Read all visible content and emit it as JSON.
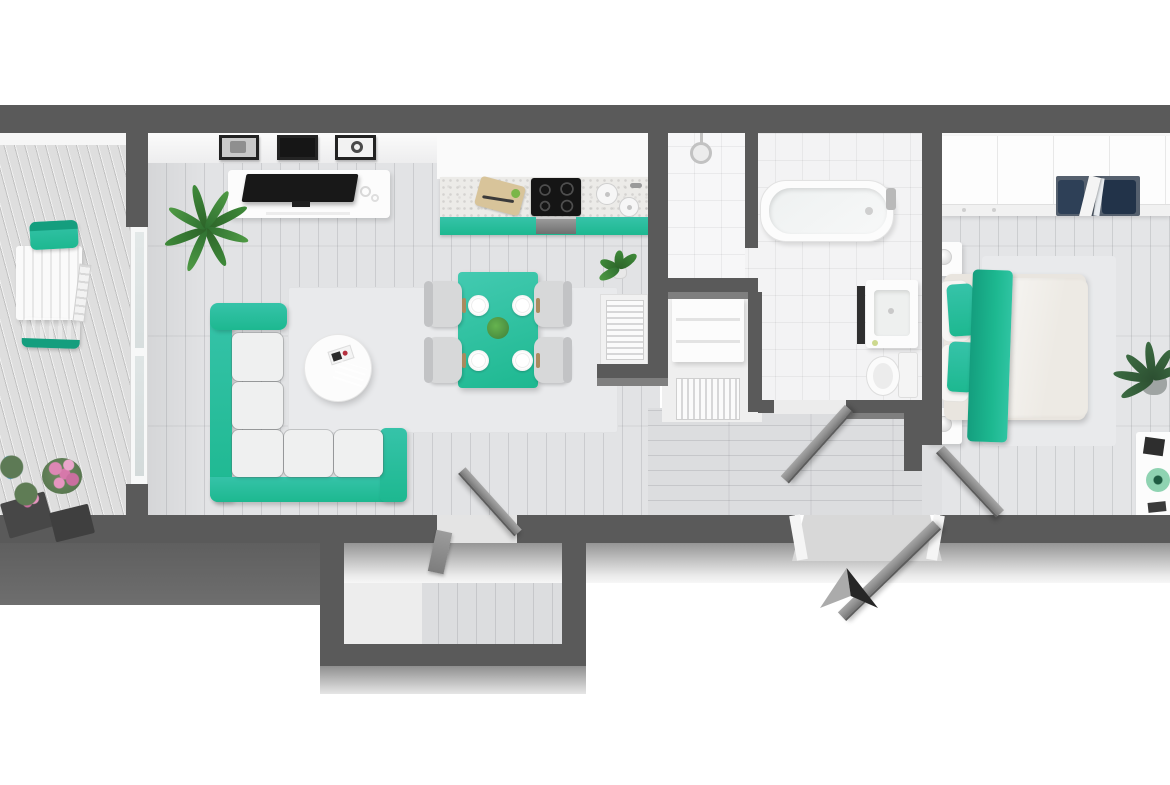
{
  "scene": {
    "title": "3D rendered apartment floor plan, top-down view",
    "description": "Photorealistic bird's-eye 3D floor plan of a one-bedroom apartment with teal accent furniture on a white background; dark gray walls; a dark arrow marks the entrance at the bottom.",
    "accent_color": "#1db890",
    "background": "#ffffff"
  },
  "palette": {
    "wall": "#5a5a5a",
    "wallFront": "#969696",
    "balconyFront": "#656565",
    "floorWood": "#e2e3e5",
    "deck": "#dedede",
    "tile": "#f3f3f4",
    "rug": "#e9eaec",
    "teal": "#1db890",
    "tealDeep": "#149e7e",
    "tealLight": "#36c3a9",
    "cushion": "#eff0f0",
    "door": "#8f8f8f",
    "white": "#fcfcfc",
    "tvBlack": "#181818",
    "arrowDark": "#262626",
    "arrowLight": "#ababab",
    "plant": "#3e8a39",
    "plantDark": "#3c6b42",
    "flowerPink": "#dd87b4",
    "flowerBlue": "#45a9de",
    "linen": "#e9e5df",
    "duvet": "#edeae4"
  },
  "rooms": {
    "balcony": {
      "label": "Balcony",
      "items": [
        "slatted outdoor table",
        "two teal folding chairs",
        "folded spare chair",
        "flower planters with pink and blue blooms"
      ]
    },
    "living_room": {
      "label": "Living room",
      "items": [
        "L-shaped teal sofa with light cushions",
        "round white coffee table with two booklets",
        "white TV sideboard with flat-screen TV",
        "three framed wall pictures",
        "potted palm plant",
        "light area rug",
        "glass sliding door to balcony"
      ]
    },
    "kitchen": {
      "label": "Kitchen",
      "items": [
        "teal base cabinets",
        "black induction cooktop",
        "oven",
        "double round sink with faucet",
        "cutting board with knife and apple",
        "radiator in niche",
        "small potted plant"
      ]
    },
    "dining_area": {
      "label": "Dining area",
      "items": [
        "teal dining table set for four",
        "four upholstered chairs",
        "white plates",
        "green centerpiece"
      ]
    },
    "shower_room": {
      "label": "Shower room",
      "items": [
        "walk-in tiled shower with shower head"
      ]
    },
    "utility_niche": {
      "label": "Utility niche",
      "items": [
        "white cabinet",
        "radiator"
      ]
    },
    "bathroom": {
      "label": "Bathroom",
      "items": [
        "built-in bathtub with faucet",
        "vanity with sink and dark mirror",
        "toilet",
        "door ajar"
      ]
    },
    "hallway": {
      "label": "Hallway",
      "items": [
        "entrance door ajar",
        "bathroom door ajar",
        "bedroom door ajar"
      ]
    },
    "storage_room": {
      "label": "Storage room",
      "items": [
        "open gray door",
        "second door leaf"
      ]
    },
    "bedroom": {
      "label": "Bedroom",
      "items": [
        "double bed with beige duvet, teal pillows and teal runner",
        "two white nightstands with sphere lamps",
        "built-in wardrobe with open sliding doors and clothes",
        "potted plant",
        "white desk with green disc decor"
      ]
    }
  },
  "annotations": {
    "entrance_marker": "two-tone dark arrow pointing up at the entrance door"
  }
}
